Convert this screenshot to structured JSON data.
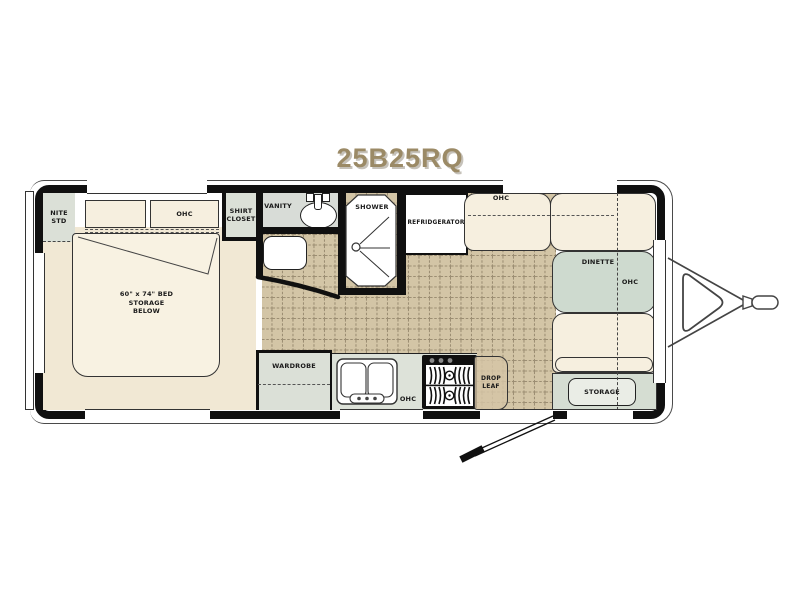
{
  "title": "25B25RQ",
  "rooms": {
    "nite_std": "NITE\nSTD",
    "bed_ohc": "OHC",
    "shirt_closet": "SHIRT\nCLOSET",
    "bed": "60\" x 74\" BED\nSTORAGE\nBELOW",
    "vanity": "VANITY",
    "shower": "SHOWER",
    "refrigerator": "REFRIDGERATOR",
    "front_ohc": "OHC",
    "dinette": "DINETTE",
    "dinette_ohc": "OHC",
    "wardrobe": "WARDROBE",
    "kitchen_ohc": "OHC",
    "drop_leaf": "DROP\nLEAF",
    "storage": "STORAGE"
  },
  "colors": {
    "title_color": "#9b8a66",
    "wall": "#101010",
    "tile": "#d3c5a6",
    "tile_line": "#9c8e73",
    "cream": "#f6efdf",
    "bed_floor": "#f1e8d4",
    "green": "#dbe0d7",
    "table_green": "#cedacf",
    "storage_green": "#d5ddd2",
    "counter_green": "#dde2d9",
    "drop_leaf_tan": "#d5c5a6"
  }
}
